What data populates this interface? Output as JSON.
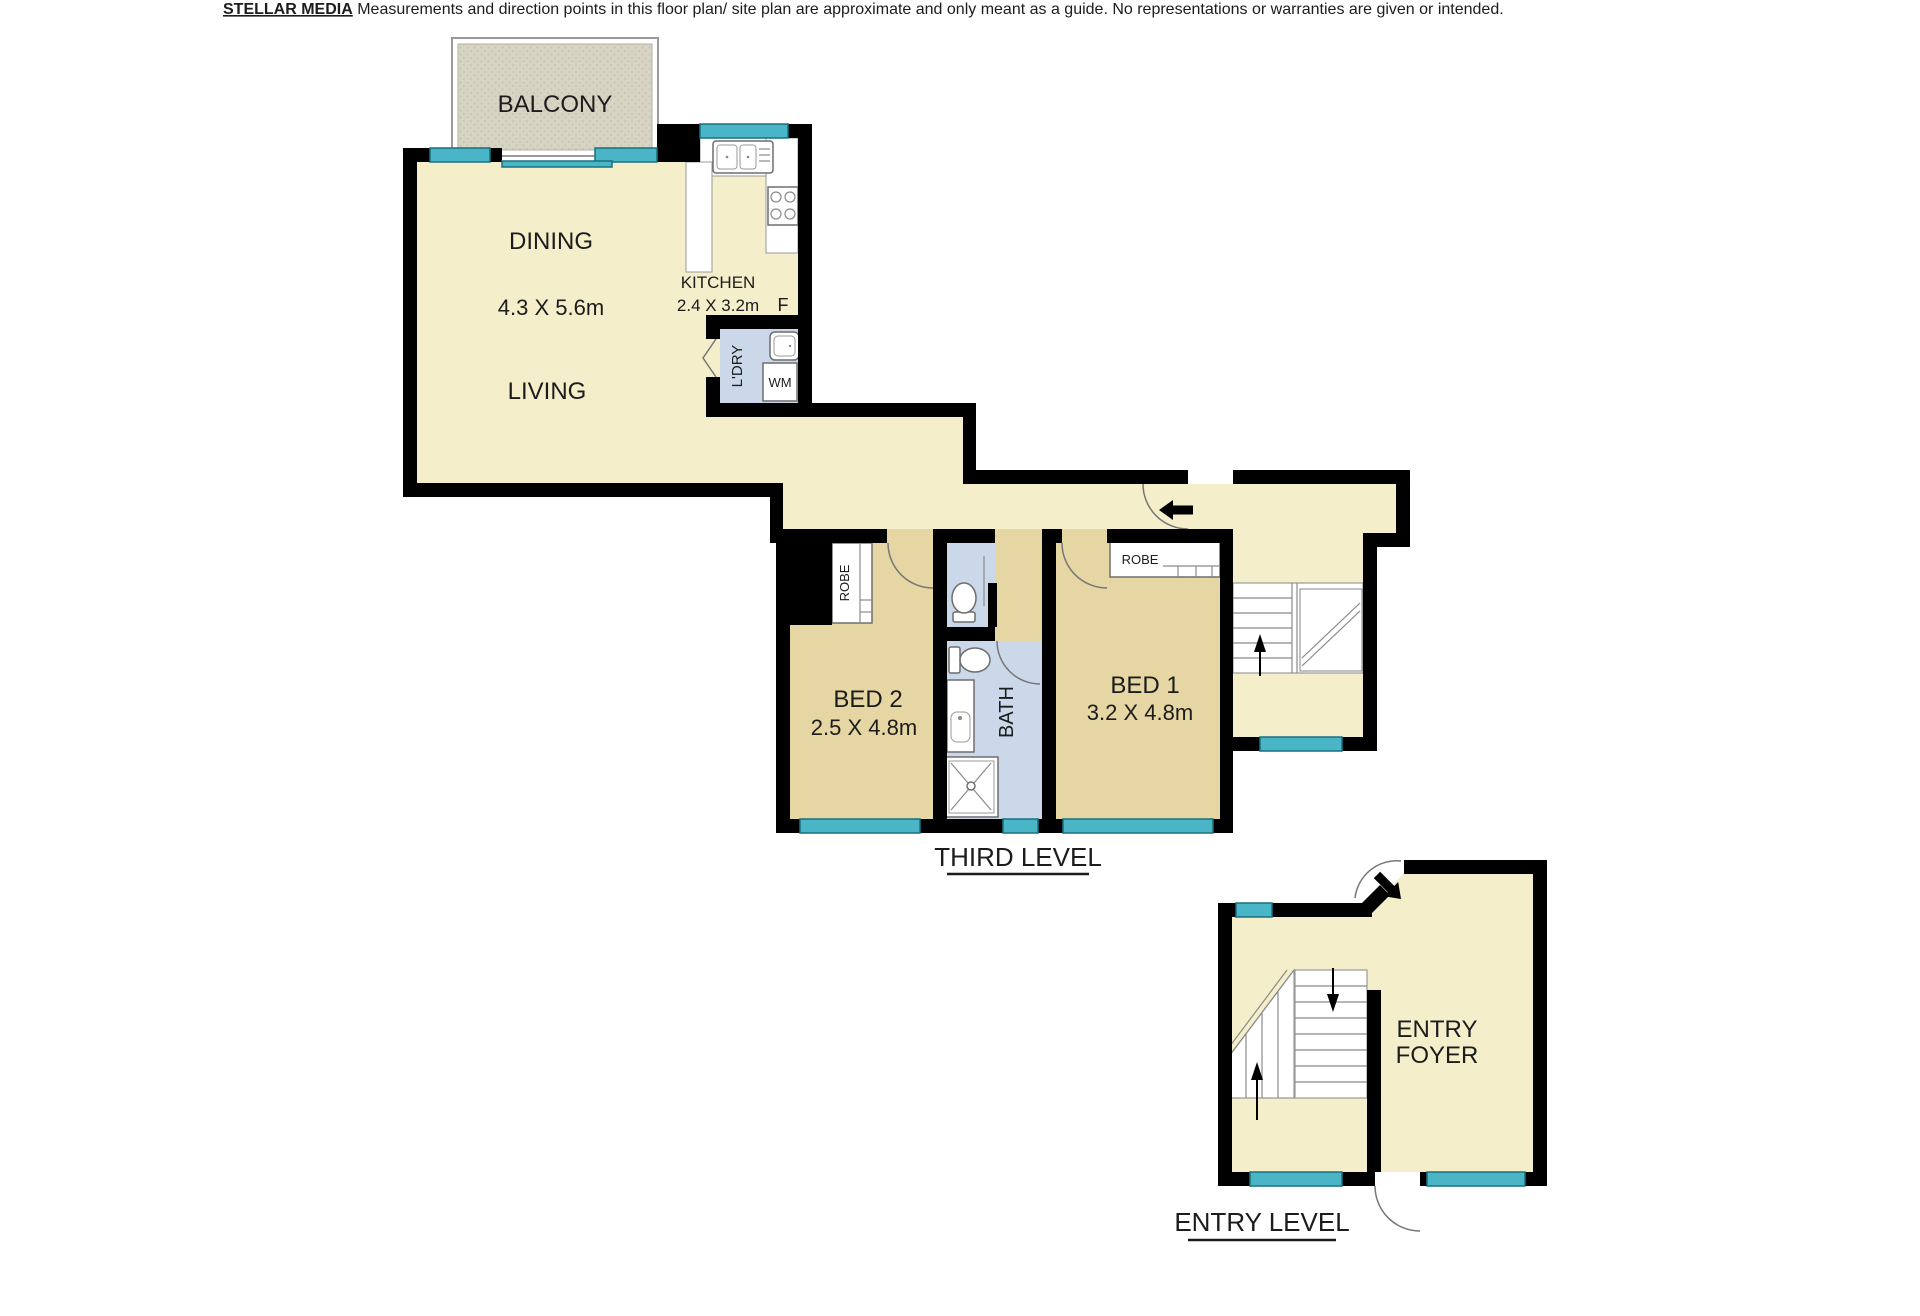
{
  "disclaimer": {
    "brand": "STELLAR MEDIA",
    "text": " Measurements and direction points in this floor plan/ site plan are approximate and only meant as a guide. No representations or warranties are given or intended."
  },
  "third_level": {
    "label": "THIRD LEVEL",
    "balcony": "BALCONY",
    "dining": "DINING",
    "living_dims": "4.3 X 5.6m",
    "living": "LIVING",
    "kitchen": "KITCHEN",
    "kitchen_dims": "2.4 X 3.2m",
    "fridge": "F",
    "laundry": "L'DRY",
    "washing_machine": "WM",
    "bed2": "BED 2",
    "bed2_dims": "2.5 X 4.8m",
    "bed2_robe": "ROBE",
    "bath": "BATH",
    "bed1": "BED 1",
    "bed1_dims": "3.2 X 4.8m",
    "bed1_robe": "ROBE"
  },
  "entry_level": {
    "label": "ENTRY LEVEL",
    "foyer_line1": "ENTRY",
    "foyer_line2": "FOYER"
  },
  "fixtures": [
    "kitchen-sink",
    "cooktop",
    "fridge",
    "laundry-tub",
    "washing-machine",
    "toilet",
    "vanity-basin",
    "shower",
    "wardrobe",
    "stairs",
    "door-swing",
    "window"
  ],
  "colors": {
    "wall": "#000000",
    "floor_main": "#f5eecb",
    "floor_bedroom": "#e6d6a4",
    "floor_wet": "#cbd8ea",
    "window": "#4ab5c6",
    "balcony": "#d7d4c4"
  }
}
